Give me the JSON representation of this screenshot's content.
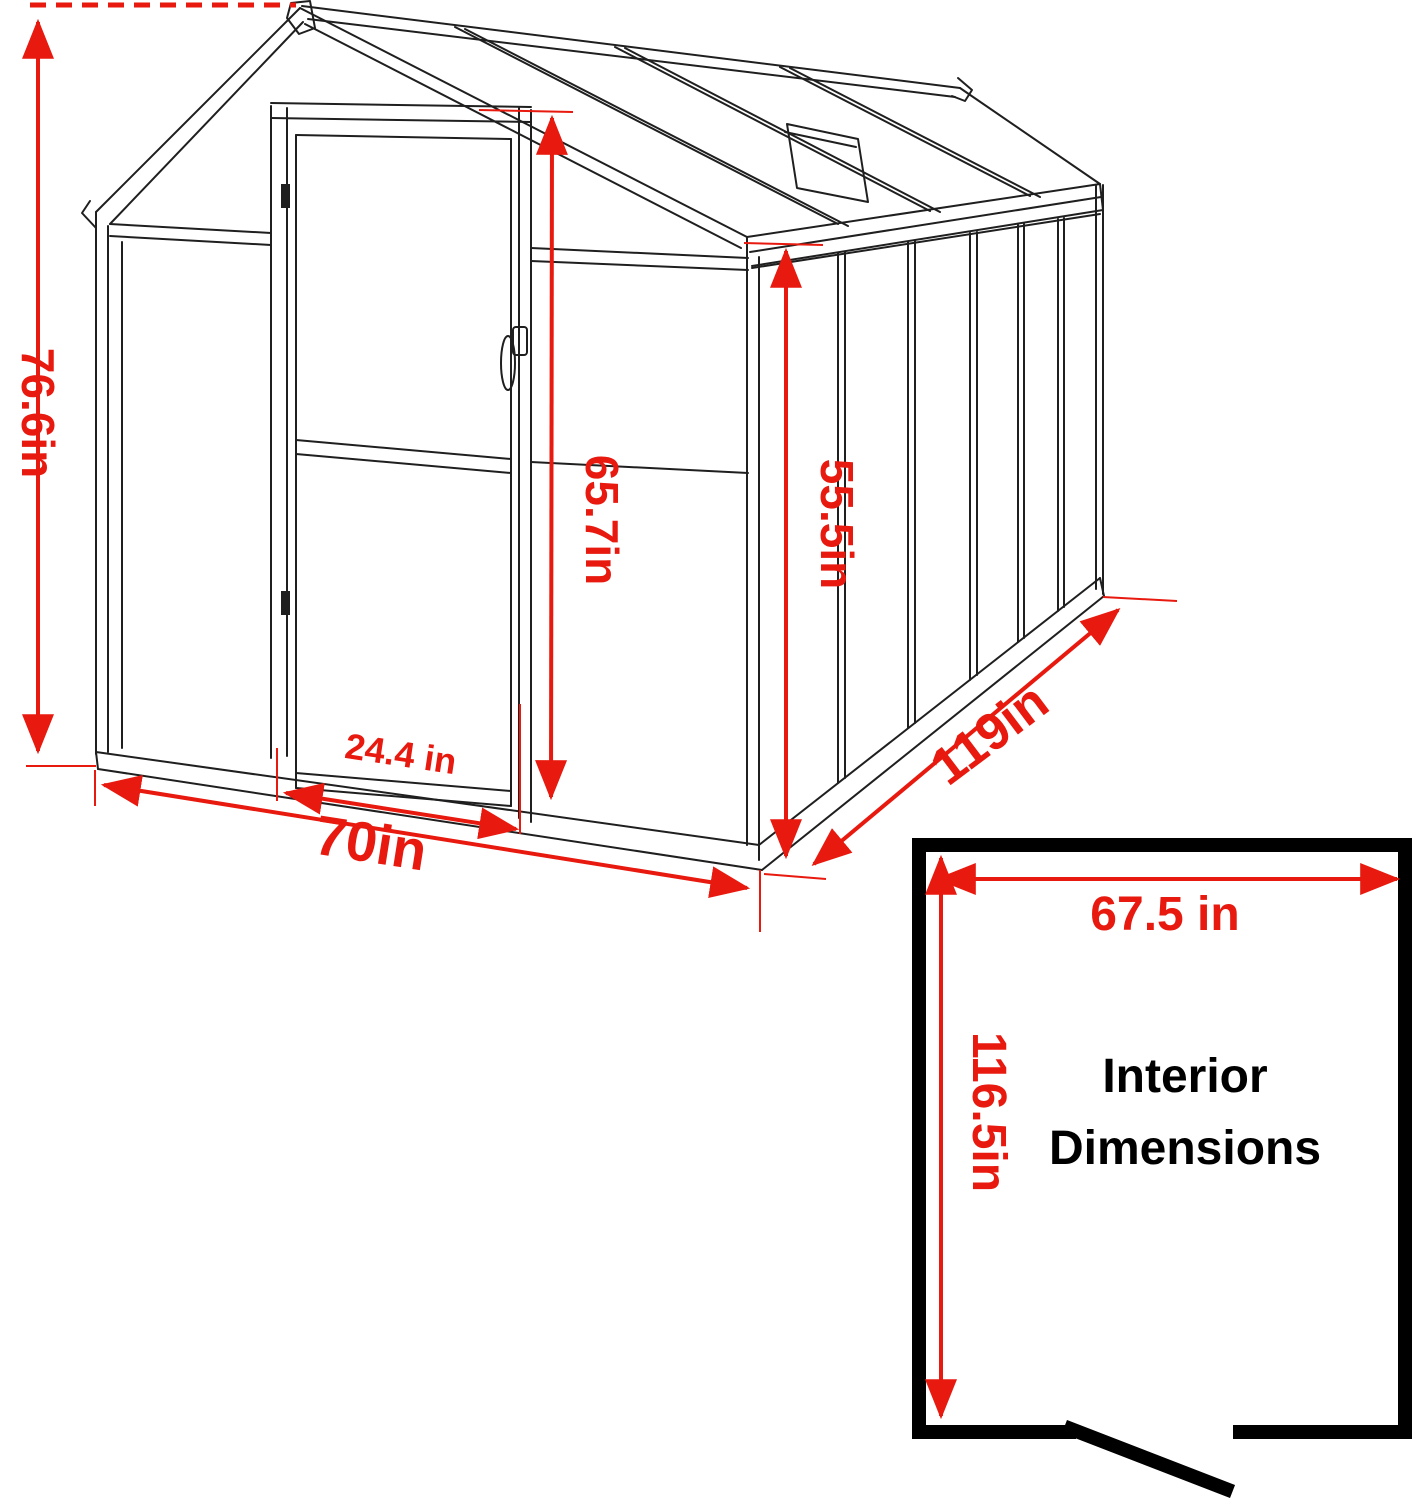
{
  "title": "Greenhouse dimension diagram",
  "colors": {
    "dimension": "#e8190e",
    "structure": "#1f1f1f",
    "interior_box": "#000000"
  },
  "dimensions": {
    "total_height": "76.6in",
    "front_width": "70in",
    "door_width": "24.4 in",
    "door_height": "65.7in",
    "side_wall_height": "55.5in",
    "depth": "119in"
  },
  "interior": {
    "heading_line1": "Interior",
    "heading_line2": "Dimensions",
    "width": "67.5 in",
    "depth": "116.5in"
  }
}
